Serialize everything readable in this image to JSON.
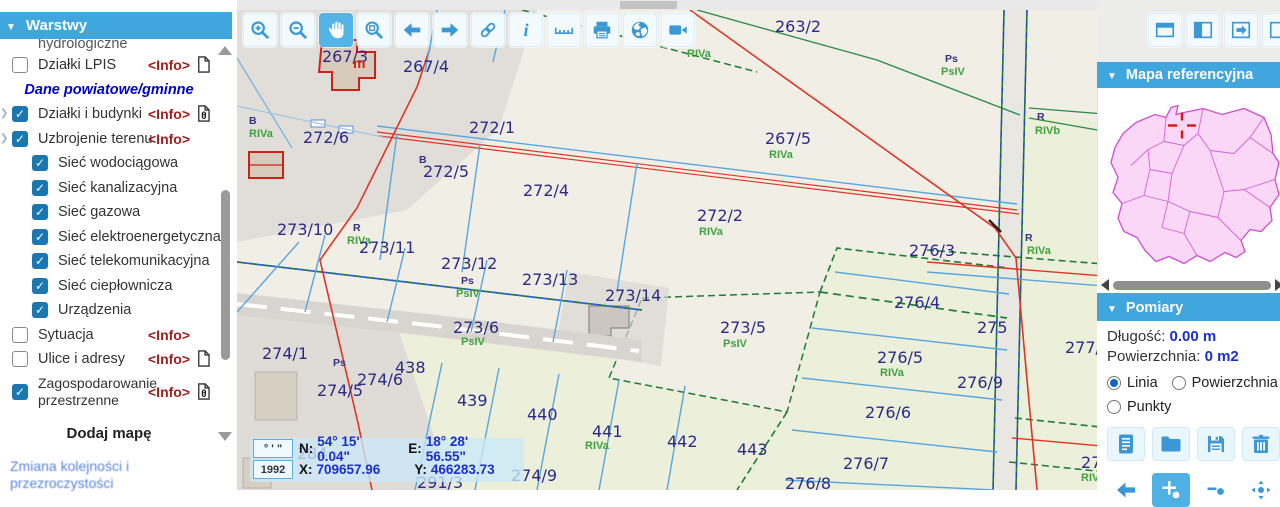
{
  "colors": {
    "accent_blue": "#3fa6de",
    "toolbar_icon_blue": "#3c98d4",
    "active_tool_bg": "#55b4e6",
    "checkbox_blue": "#1a77b0",
    "info_link_red": "#a21d1d",
    "value_blue": "#1a2fd0",
    "parcel_text_navy": "#2b2b85",
    "landuse_green": "#3ea23e",
    "map_cream": "#f1eee6",
    "map_field_green": "#ecefda",
    "poland_fill": "#fad7f6",
    "poland_border": "#cf4ccf"
  },
  "sidebar": {
    "title": "Warstwy",
    "info_label": "<Info>",
    "add_map_label": "Dodaj mapę",
    "reorder_link": "Zmiana kolejności i przezroczystości",
    "items": [
      {
        "type": "partial",
        "label": "hydrologiczne"
      },
      {
        "type": "layer",
        "checked": false,
        "label": "Działki LPIS",
        "info": true,
        "icon": "document-icon"
      },
      {
        "type": "section",
        "label": "Dane powiatowe/gminne"
      },
      {
        "type": "layer",
        "checked": true,
        "label": "Działki i budynki",
        "info": true,
        "icon": "document-info-icon",
        "expand": true
      },
      {
        "type": "layer",
        "checked": true,
        "label": "Uzbrojenie terenu",
        "info": true,
        "expand": true
      },
      {
        "type": "sub",
        "checked": true,
        "label": "Sieć wodociągowa"
      },
      {
        "type": "sub",
        "checked": true,
        "label": "Sieć kanalizacyjna"
      },
      {
        "type": "sub",
        "checked": true,
        "label": "Sieć gazowa"
      },
      {
        "type": "sub",
        "checked": true,
        "label": "Sieć elektroenergetyczna"
      },
      {
        "type": "sub",
        "checked": true,
        "label": "Sieć telekomunikacyjna"
      },
      {
        "type": "sub",
        "checked": true,
        "label": "Sieć ciepłownicza"
      },
      {
        "type": "sub",
        "checked": true,
        "label": "Urządzenia"
      },
      {
        "type": "layer",
        "checked": false,
        "label": "Sytuacja",
        "info": true
      },
      {
        "type": "layer",
        "checked": false,
        "label": "Ulice i adresy",
        "info": true,
        "icon": "document-icon"
      },
      {
        "type": "layer",
        "checked": true,
        "label": "Zagospodarowanie przestrzenne",
        "info": true,
        "icon": "document-info-icon",
        "wrap": true
      }
    ]
  },
  "toolbar": {
    "buttons": [
      {
        "icon": "zoom-in-icon"
      },
      {
        "icon": "zoom-out-icon"
      },
      {
        "icon": "pan-icon",
        "active": true
      },
      {
        "icon": "zoom-extent-icon"
      },
      {
        "icon": "previous-view-icon"
      },
      {
        "icon": "next-view-icon"
      },
      {
        "icon": "link-icon"
      },
      {
        "icon": "identify-icon"
      },
      {
        "icon": "measure-icon"
      },
      {
        "icon": "print-icon"
      },
      {
        "icon": "globe-icon"
      },
      {
        "icon": "video-icon"
      }
    ]
  },
  "top_right_toolbar": {
    "buttons": [
      {
        "icon": "layout-top-icon"
      },
      {
        "icon": "layout-left-icon"
      },
      {
        "icon": "panel-arrow-icon"
      },
      {
        "icon": "layout-plain-icon"
      }
    ]
  },
  "reference_panel": {
    "title": "Mapa referencyjna"
  },
  "measure_panel": {
    "title": "Pomiary",
    "length_label": "Długość:",
    "length_value": "0.00 m",
    "area_label": "Powierzchnia:",
    "area_value": "0 m2",
    "radios": [
      {
        "label": "Linia",
        "selected": true
      },
      {
        "label": "Powierzchnia",
        "selected": false
      },
      {
        "label": "Punkty",
        "selected": false
      }
    ],
    "file_buttons": [
      {
        "icon": "report-icon"
      },
      {
        "icon": "folder-icon"
      },
      {
        "icon": "save-icon"
      },
      {
        "icon": "trash-icon"
      }
    ],
    "edit_buttons": [
      {
        "icon": "back-arrow-icon",
        "bare": true
      },
      {
        "icon": "add-point-icon",
        "active": true
      },
      {
        "icon": "remove-point-icon",
        "bare": true
      },
      {
        "icon": "move-point-icon",
        "bare": true
      }
    ]
  },
  "coords": {
    "dms_symbols": "° ' \"",
    "epsg": "1992",
    "n_label": "N:",
    "n_value": "54° 15' 0.04\"",
    "e_label": "E:",
    "e_value": "18° 28' 56.55\"",
    "x_label": "X:",
    "x_value": "709657.96",
    "y_label": "Y:",
    "y_value": "466283.73"
  },
  "map": {
    "labels": [
      {
        "t": "263/2",
        "x": 538,
        "y": 22,
        "c": "p"
      },
      {
        "t": "267/3",
        "x": 85,
        "y": 52,
        "c": "p"
      },
      {
        "t": "m",
        "x": 116,
        "y": 58,
        "c": "r"
      },
      {
        "t": "267/4",
        "x": 166,
        "y": 62,
        "c": "p"
      },
      {
        "t": "RIVa",
        "x": 450,
        "y": 47,
        "c": "g"
      },
      {
        "t": "Ps",
        "x": 708,
        "y": 52,
        "c": "ps"
      },
      {
        "t": "PsIV",
        "x": 704,
        "y": 65,
        "c": "g"
      },
      {
        "t": "B",
        "x": 12,
        "y": 114,
        "c": "ps"
      },
      {
        "t": "RIVa",
        "x": 12,
        "y": 127,
        "c": "g"
      },
      {
        "t": "272/6",
        "x": 66,
        "y": 133,
        "c": "p"
      },
      {
        "t": "272/1",
        "x": 232,
        "y": 123,
        "c": "p"
      },
      {
        "t": "B",
        "x": 182,
        "y": 153,
        "c": "ps"
      },
      {
        "t": "272/5",
        "x": 186,
        "y": 167,
        "c": "p"
      },
      {
        "t": "272/4",
        "x": 286,
        "y": 186,
        "c": "p"
      },
      {
        "t": "267/5",
        "x": 528,
        "y": 134,
        "c": "p"
      },
      {
        "t": "RIVa",
        "x": 532,
        "y": 148,
        "c": "g"
      },
      {
        "t": "R",
        "x": 800,
        "y": 110,
        "c": "ps"
      },
      {
        "t": "RIVb",
        "x": 798,
        "y": 124,
        "c": "g"
      },
      {
        "t": "272/2",
        "x": 460,
        "y": 211,
        "c": "p"
      },
      {
        "t": "RIVa",
        "x": 462,
        "y": 225,
        "c": "g"
      },
      {
        "t": "273/10",
        "x": 40,
        "y": 225,
        "c": "p"
      },
      {
        "t": "R",
        "x": 116,
        "y": 221,
        "c": "ps"
      },
      {
        "t": "RIVa",
        "x": 110,
        "y": 234,
        "c": "g"
      },
      {
        "t": "273/11",
        "x": 122,
        "y": 243,
        "c": "p"
      },
      {
        "t": "273/12",
        "x": 204,
        "y": 259,
        "c": "p"
      },
      {
        "t": "Ps",
        "x": 224,
        "y": 274,
        "c": "ps"
      },
      {
        "t": "PsIV",
        "x": 219,
        "y": 287,
        "c": "g"
      },
      {
        "t": "273/13",
        "x": 285,
        "y": 275,
        "c": "p"
      },
      {
        "t": "273/14",
        "x": 368,
        "y": 291,
        "c": "p"
      },
      {
        "t": "276/3",
        "x": 672,
        "y": 246,
        "c": "p"
      },
      {
        "t": "273/6",
        "x": 216,
        "y": 323,
        "c": "p"
      },
      {
        "t": "PsIV",
        "x": 224,
        "y": 335,
        "c": "g"
      },
      {
        "t": "273/5",
        "x": 483,
        "y": 323,
        "c": "p"
      },
      {
        "t": "PsIV",
        "x": 486,
        "y": 337,
        "c": "g"
      },
      {
        "t": "274/1",
        "x": 25,
        "y": 349,
        "c": "p"
      },
      {
        "t": "Ps",
        "x": 96,
        "y": 356,
        "c": "ps"
      },
      {
        "t": "438",
        "x": 158,
        "y": 363,
        "c": "p"
      },
      {
        "t": "274/6",
        "x": 120,
        "y": 375,
        "c": "p"
      },
      {
        "t": "274/5",
        "x": 80,
        "y": 386,
        "c": "p"
      },
      {
        "t": "439",
        "x": 220,
        "y": 396,
        "c": "p"
      },
      {
        "t": "276/4",
        "x": 657,
        "y": 298,
        "c": "p"
      },
      {
        "t": "275",
        "x": 740,
        "y": 323,
        "c": "p"
      },
      {
        "t": "276/5",
        "x": 640,
        "y": 353,
        "c": "p"
      },
      {
        "t": "RIVa",
        "x": 643,
        "y": 366,
        "c": "g"
      },
      {
        "t": "276/9",
        "x": 720,
        "y": 378,
        "c": "p"
      },
      {
        "t": "277/1",
        "x": 828,
        "y": 343,
        "c": "p"
      },
      {
        "t": "R",
        "x": 788,
        "y": 231,
        "c": "ps"
      },
      {
        "t": "RIVa",
        "x": 790,
        "y": 244,
        "c": "g"
      },
      {
        "t": "440",
        "x": 290,
        "y": 410,
        "c": "p"
      },
      {
        "t": "441",
        "x": 355,
        "y": 427,
        "c": "p"
      },
      {
        "t": "RIVa",
        "x": 348,
        "y": 439,
        "c": "g"
      },
      {
        "t": "442",
        "x": 430,
        "y": 437,
        "c": "p"
      },
      {
        "t": "443",
        "x": 500,
        "y": 445,
        "c": "p"
      },
      {
        "t": "276/6",
        "x": 628,
        "y": 408,
        "c": "p"
      },
      {
        "t": "276/7",
        "x": 606,
        "y": 459,
        "c": "p"
      },
      {
        "t": "276/8",
        "x": 548,
        "y": 479,
        "c": "p"
      },
      {
        "t": "278",
        "x": 844,
        "y": 458,
        "c": "p"
      },
      {
        "t": "RIVa",
        "x": 844,
        "y": 471,
        "c": "g"
      },
      {
        "t": "274/9",
        "x": 274,
        "y": 471,
        "c": "p"
      },
      {
        "t": "291/3",
        "x": 180,
        "y": 478,
        "c": "p"
      },
      {
        "t": "284",
        "x": 60,
        "y": 449,
        "c": "p"
      }
    ]
  }
}
